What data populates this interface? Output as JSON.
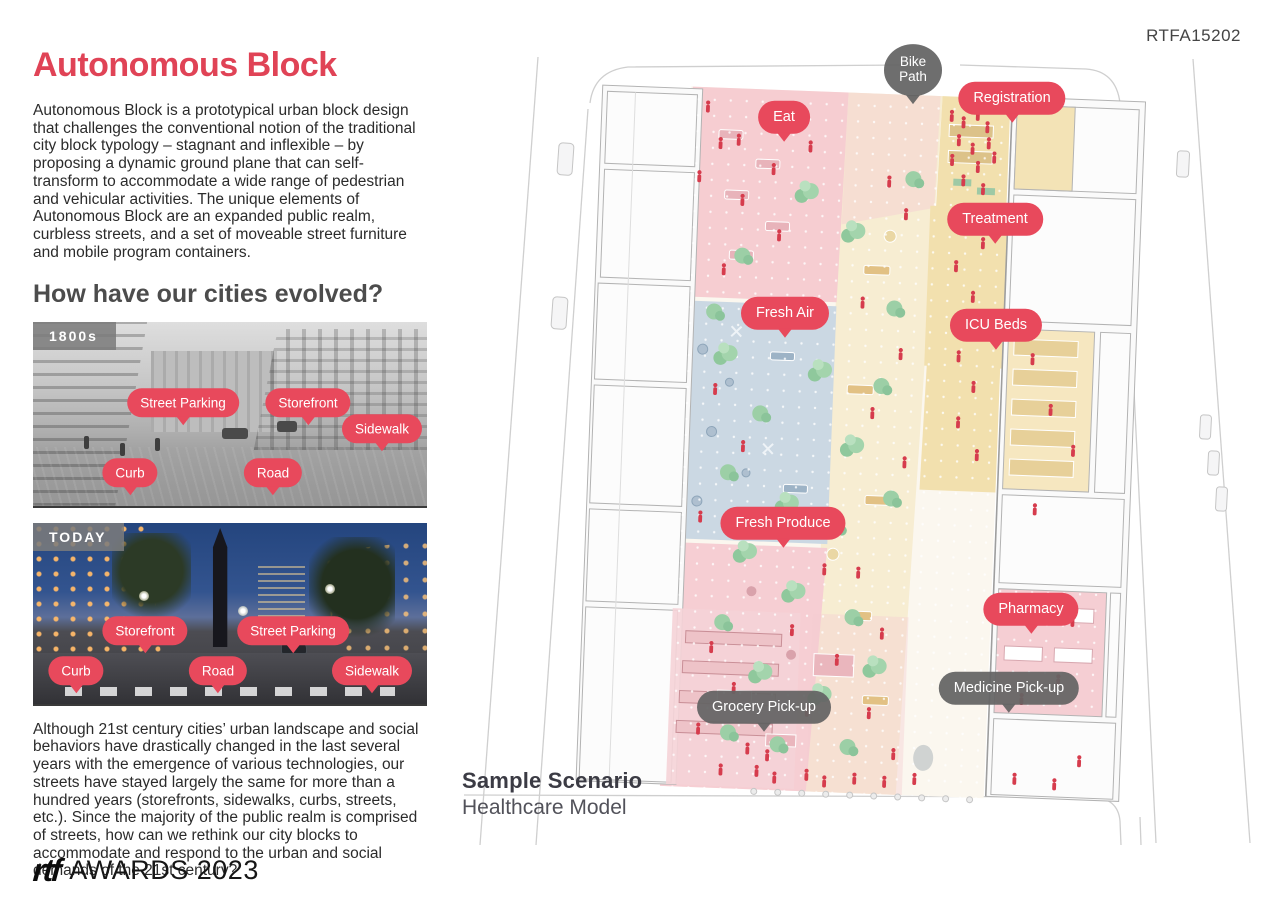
{
  "page": {
    "code": "RTFA15202"
  },
  "intro": {
    "title": "Autonomous Block",
    "body": "Autonomous Block is a prototypical urban block design that challenges the conventional notion of the traditional city block typology – stagnant and inflexible – by proposing a dynamic ground plane that can self-transform to accommodate a wide range of pedestrian and vehicular activities. The unique elements of Autonomous Block are an expanded public realm, curbless streets, and a set of moveable street furniture and mobile program containers."
  },
  "evolution": {
    "heading": "How have our cities evolved?",
    "cards": [
      {
        "badge": "1800s",
        "callouts": [
          {
            "label": "Street Parking"
          },
          {
            "label": "Storefront"
          },
          {
            "label": "Sidewalk"
          },
          {
            "label": "Curb"
          },
          {
            "label": "Road"
          }
        ]
      },
      {
        "badge": "TODAY",
        "callouts": [
          {
            "label": "Storefront"
          },
          {
            "label": "Street Parking"
          },
          {
            "label": "Curb"
          },
          {
            "label": "Road"
          },
          {
            "label": "Sidewalk"
          }
        ]
      }
    ],
    "outro": "Although 21st century cities’ urban landscape and social behaviors have drastically changed in the last several years with the emergence of various technologies, our streets have stayed largely the same for more than a hundred years (storefronts, sidewalks, curbs, streets, etc.). Since the majority of the public realm is comprised of streets, how can we rethink our city blocks to accommodate and respond to the urban and social demands of the 21st century?"
  },
  "scenario": {
    "title": "Sample Scenario",
    "subtitle": "Healthcare Model"
  },
  "illustration": {
    "callouts": [
      {
        "label": "Bike Path"
      },
      {
        "label": "Registration"
      },
      {
        "label": "Eat"
      },
      {
        "label": "Treatment"
      },
      {
        "label": "Fresh Air"
      },
      {
        "label": "ICU Beds"
      },
      {
        "label": "Fresh Produce"
      },
      {
        "label": "Pharmacy"
      },
      {
        "label": "Medicine Pick-up"
      },
      {
        "label": "Grocery Pick-up"
      }
    ]
  },
  "footer": {
    "logo_mark": "rtf",
    "logo_text": "AWARDS 2023"
  },
  "colors": {
    "accent_red": "#e8495c",
    "bubble_dark": "#646464",
    "badge_gray": "#7c7c7c"
  }
}
